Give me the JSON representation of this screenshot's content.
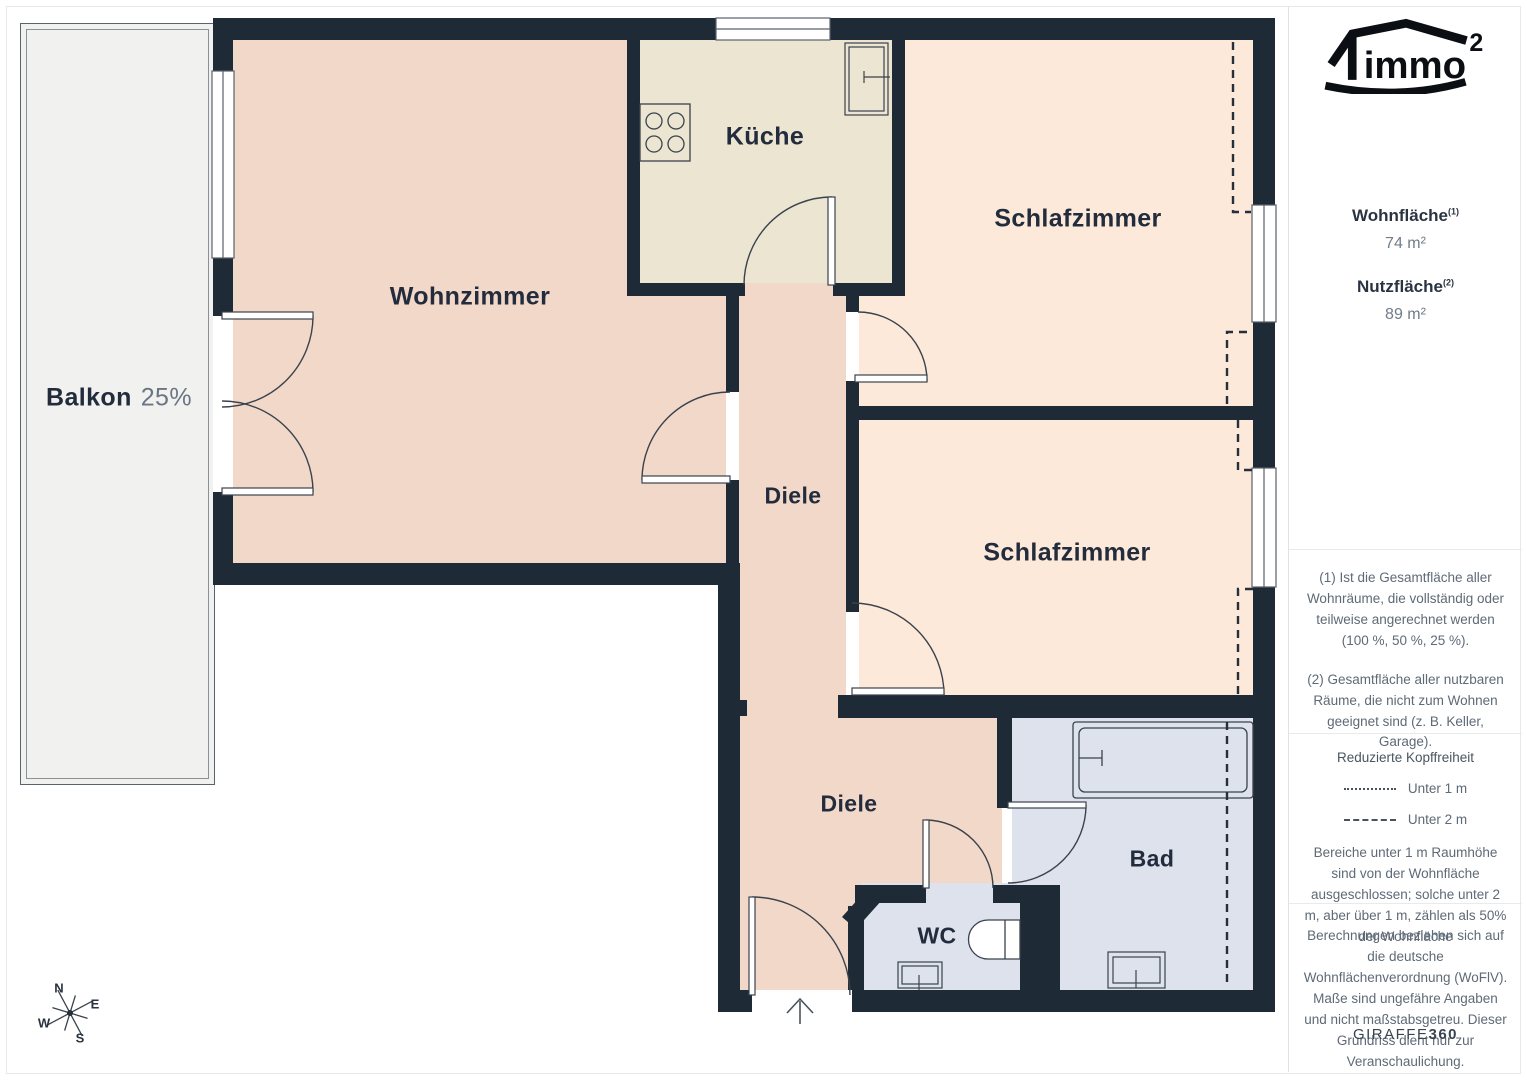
{
  "floorplan": {
    "rooms": [
      {
        "id": "balkon",
        "label": "Balkon",
        "suffix": "25%"
      },
      {
        "id": "wohnzimmer",
        "label": "Wohnzimmer"
      },
      {
        "id": "kueche",
        "label": "Küche"
      },
      {
        "id": "schlafzimmer-top",
        "label": "Schlafzimmer"
      },
      {
        "id": "schlafzimmer-mid",
        "label": "Schlafzimmer"
      },
      {
        "id": "diele-upper",
        "label": "Diele"
      },
      {
        "id": "diele-lower",
        "label": "Diele"
      },
      {
        "id": "bad",
        "label": "Bad"
      },
      {
        "id": "wc",
        "label": "WC"
      }
    ],
    "compass": {
      "n": "N",
      "e": "E",
      "s": "S",
      "w": "W"
    },
    "colors": {
      "wall": "#1f2a37",
      "living_floor": "#f2d8c8",
      "kitchen_floor": "#ebe5d2",
      "bedroom_floor": "#fce9d9",
      "bath_floor": "#dde2ed",
      "balcony_floor": "#f1f1ef",
      "label_text": "#232c3d",
      "muted_text": "#6b7684"
    }
  },
  "sidebar": {
    "logo": {
      "text": "immo",
      "sup": "2"
    },
    "metrics": [
      {
        "label": "Wohnfläche",
        "sup": "(1)",
        "value": "74 m²"
      },
      {
        "label": "Nutzfläche",
        "sup": "(2)",
        "value": "89 m²"
      }
    ],
    "notes": [
      "(1) Ist die Gesamtfläche aller Wohnräume, die vollständig oder teilweise angerechnet werden (100 %, 50 %, 25 %).",
      "(2) Gesamtfläche aller nutzbaren Räume, die nicht zum Wohnen geeignet sind (z. B. Keller, Garage)."
    ],
    "headroom": {
      "title": "Reduzierte Kopffreiheit",
      "legend": [
        {
          "label": "Unter 1 m"
        },
        {
          "label": "Unter 2 m"
        }
      ],
      "body": "Bereiche unter 1 m Raumhöhe sind von der Wohnfläche ausgeschlossen; solche unter 2 m, aber über 1 m, zählen als 50% der Wohnfläche"
    },
    "disclaimer": "Berechnungen beziehen sich auf die deutsche Wohnflächenverordnung (WoFlV). Maße sind ungefähre Angaben und nicht maßstabsgetreu. Dieser Grundriss dient nur zur Veranschaulichung.",
    "brand": {
      "name": "GIRAFFE",
      "bold": "360"
    }
  }
}
